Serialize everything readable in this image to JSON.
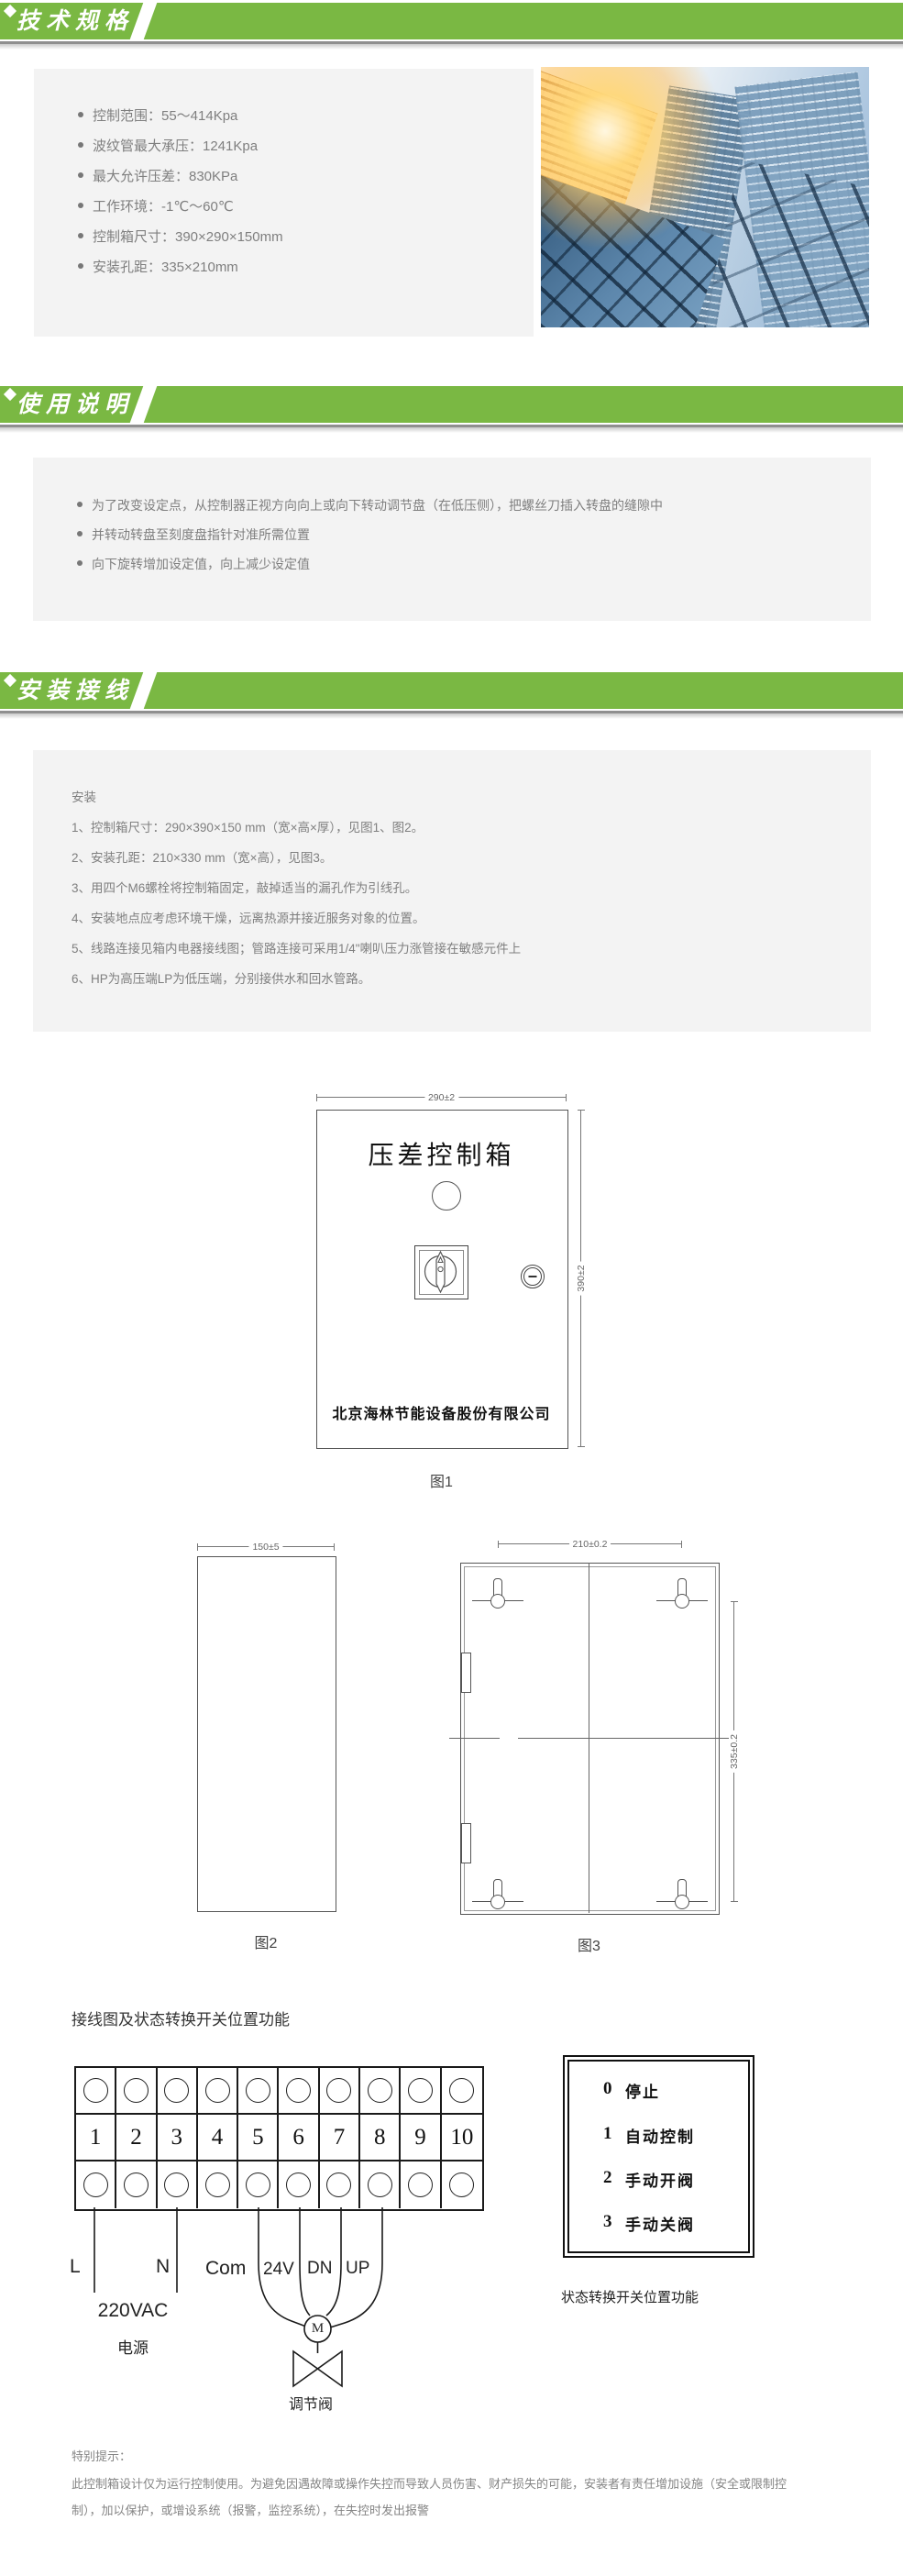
{
  "colors": {
    "accent_green": "#7ab843",
    "box_bg": "#f3f3f3",
    "body_text": "#808080",
    "drawing_line": "#555555"
  },
  "sections": {
    "tech": {
      "title": "技术规格",
      "specs": [
        "控制范围：55～414Kpa",
        "波纹管最大承压：1241Kpa",
        "最大允许压差：830KPa",
        "工作环境：-1℃～60℃",
        "控制箱尺寸：390×290×150mm",
        "安装孔距：335×210mm"
      ]
    },
    "usage": {
      "title": "使用说明",
      "bullets": [
        "为了改变设定点，从控制器正视方向向上或向下转动调节盘（在低压侧），把螺丝刀插入转盘的缝隙中",
        "并转动转盘至刻度盘指针对准所需位置",
        "向下旋转增加设定值，向上减少设定值"
      ]
    },
    "install": {
      "title": "安装接线",
      "heading": "安装",
      "steps": [
        "1、控制箱尺寸：290×390×150 mm（宽×高×厚），见图1、图2。",
        "2、安装孔距：210×330 mm（宽×高），见图3。",
        "3、用四个M6螺栓将控制箱固定，敲掉适当的漏孔作为引线孔。",
        "4、安装地点应考虑环境干燥，远离热源并接近服务对象的位置。",
        "5、线路连接见箱内电器接线图；管路连接可采用1/4\"喇叭压力涨管接在敏感元件上",
        "6、HP为高压端LP为低压端，分别接供水和回水管路。"
      ]
    }
  },
  "figures": {
    "fig1": {
      "dim_top": "290±2",
      "dim_right": "390±2",
      "panel_title": "压差控制箱",
      "company": "北京海林节能设备股份有限公司",
      "caption": "图1"
    },
    "fig2": {
      "dim_top": "150±5",
      "caption": "图2"
    },
    "fig3": {
      "dim_top": "210±0.2",
      "dim_right": "335±0.2",
      "caption": "图3"
    }
  },
  "wiring": {
    "title": "接线图及状态转换开关位置功能",
    "terminals": [
      "1",
      "2",
      "3",
      "4",
      "5",
      "6",
      "7",
      "8",
      "9",
      "10"
    ],
    "line_label": "L",
    "neutral_label": "N",
    "com_label": "Com",
    "v24_label": "24V",
    "dn_label": "DN",
    "up_label": "UP",
    "power": "220VAC",
    "power_cn": "电源",
    "motor": "M",
    "valve": "调节阀"
  },
  "switchbox": {
    "items": [
      {
        "num": "0",
        "label": "停止"
      },
      {
        "num": "1",
        "label": "自动控制"
      },
      {
        "num": "2",
        "label": "手动开阀"
      },
      {
        "num": "3",
        "label": "手动关阀"
      }
    ],
    "caption": "状态转换开关位置功能"
  },
  "notice": {
    "title": "特别提示：",
    "line1": "此控制箱设计仅为运行控制使用。为避免因遇故障或操作失控而导致人员伤害、财产损失的可能，安装者有责任增加设施（安全或限制控",
    "line2": "制），加以保护，或增设系统（报警，监控系统），在失控时发出报警"
  }
}
